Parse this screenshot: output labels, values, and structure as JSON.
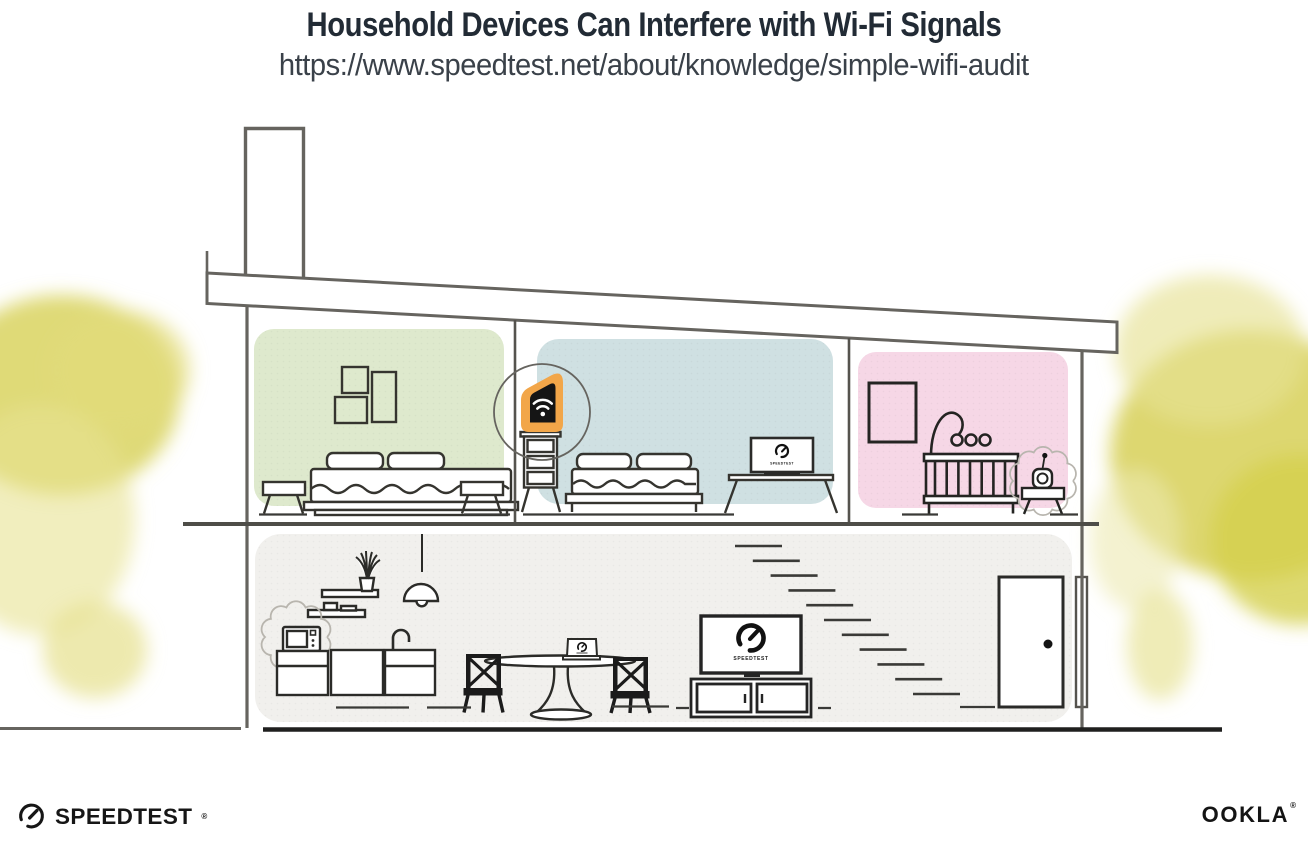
{
  "page": {
    "title": "Household Devices Can Interfere with Wi-Fi Signals",
    "url": "https://www.speedtest.net/about/knowledge/simple-wifi-audit"
  },
  "branding": {
    "speedtest_wordmark": "SPEEDTEST",
    "speedtest_reg_mark": "®",
    "ookla_wordmark": "OOKLA",
    "ookla_reg_mark": "®"
  },
  "illustration": {
    "screen_labels": {
      "bedroom_monitor": "SPEEDTEST",
      "living_room_tv": "SPEEDTEST"
    },
    "icons": {
      "wifi_icon": "three arcs + dot",
      "speedtest_gauge_icon": "open ring + needle"
    },
    "colors": {
      "accent_orange": "#F2A649",
      "bedroom_green": "#DEE9CD",
      "bedroom_blue": "#CFE0E2",
      "nursery_pink": "#F6D7E6",
      "lower_floor_gray": "#F1F0ED",
      "foliage_yellow": "#D9D35F",
      "outline_gray": "#66645F",
      "ink": "#1C1C1A"
    }
  }
}
